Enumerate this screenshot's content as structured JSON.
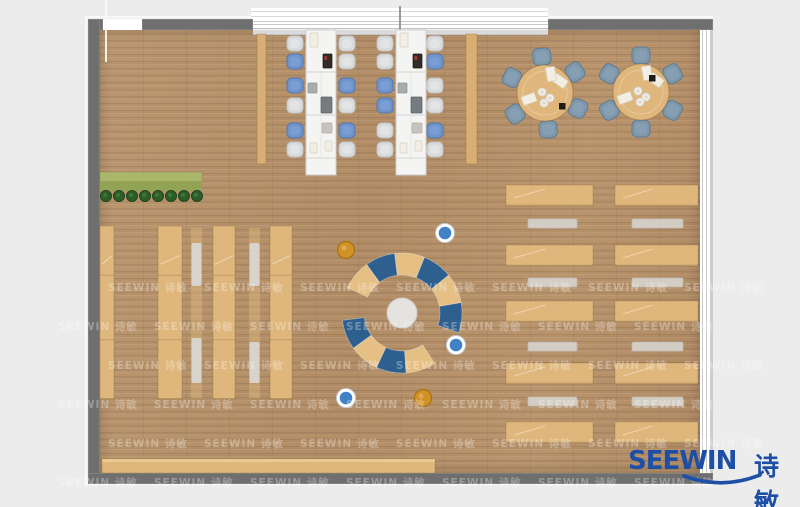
{
  "logo": {
    "text_en": "SEEWIN",
    "text_cn": "诗敏",
    "color": "#1d4fa7"
  },
  "watermark": {
    "text": "SEEWIN 诗敏",
    "color": "rgba(255,255,255,0.30)",
    "row0_y": 280,
    "row_step": 39,
    "rows": 6,
    "col_step": 96,
    "x_even": 108,
    "x_odd": 58,
    "count": 7
  },
  "palette": {
    "bg": "#ececec",
    "wall": "#6f6f6f",
    "floor": "#b6926b",
    "wood": "#dfb77c",
    "wood_dark": "#d7ae74",
    "wood_edge": "rgba(120,80,30,0.30)",
    "table_white": "#f4f4f3",
    "table_edge": "#cfcfcf",
    "seam": "#d9d9d9",
    "chair_gray": "#d9dadb",
    "chair_gray_edge": "#bfc1c3",
    "chair_blue": "#6f94cc",
    "chair_blue_edge": "#5577ad",
    "chair_steel": "#7d97ab",
    "chair_steel_edge": "#5f7b92",
    "bench_gray": "#d6d3cc",
    "bench_edge": "#c2bfb8",
    "mat": "#d9d6d0",
    "arc_tan": "#e5bf83",
    "arc_blue": "#2d608f",
    "center_circle": "#e5e3df",
    "center_edge": "#cfcdc8",
    "pouf_blue": "#4181c6",
    "pouf_orange": "#d09125",
    "pouf_orange_edge": "#a86f12",
    "plant_light": "#aab76a",
    "plant_dark": "#93a355",
    "tree": "#2f5d2a",
    "tree_edge": "#1f4420",
    "item_paper": "#f2eee3",
    "item_paper_edge": "#d6d0bf",
    "item_dark": "#332b26",
    "item_laptop": "#a7acaf",
    "item_laptop_dark": "#757b7f",
    "item_tray": "#c7c4bd"
  },
  "room": {
    "floor": {
      "x": 100,
      "y": 29,
      "w": 600,
      "h": 444
    },
    "outline": {
      "x": 85,
      "y": 16,
      "w": 624,
      "h": 465
    },
    "walls": [
      {
        "name": "wall-top-corner-left",
        "x": 88,
        "y": 19,
        "w": 15,
        "h": 11
      },
      {
        "name": "wall-top-left",
        "x": 142,
        "y": 19,
        "w": 111,
        "h": 11
      },
      {
        "name": "wall-top-right",
        "x": 548,
        "y": 19,
        "w": 165,
        "h": 11
      },
      {
        "name": "wall-left",
        "x": 88,
        "y": 19,
        "w": 12,
        "h": 465
      },
      {
        "name": "wall-bottom",
        "x": 88,
        "y": 473,
        "w": 625,
        "h": 11
      },
      {
        "name": "wall-right-segment",
        "x": 700,
        "y": 110,
        "w": 13,
        "h": 70
      }
    ],
    "windows": {
      "top": {
        "x": 253,
        "y": 19,
        "w": 295,
        "h": 11
      },
      "top_outer": {
        "x": 251,
        "y": 6,
        "w": 297,
        "h": 13
      },
      "top_sill": {
        "x": 253,
        "y": 30,
        "w": 295,
        "h": 4
      },
      "divider": {
        "x": 399,
        "y": 6,
        "w": 2,
        "h": 24
      },
      "right": {
        "x": 700,
        "y": 30,
        "w": 10,
        "h": 443
      },
      "door_gap": {
        "x": 103,
        "y": 19,
        "w": 39,
        "h": 11
      },
      "door_line": {
        "x": 105,
        "y": 0,
        "w": 2,
        "h": 62
      }
    }
  },
  "furniture": {
    "side_panels": [
      {
        "x": 257,
        "y": 34,
        "w": 9,
        "h": 130
      },
      {
        "x": 466,
        "y": 34,
        "w": 11,
        "h": 130
      }
    ],
    "planter": {
      "x": 100,
      "y": 172,
      "w": 102,
      "h": 19,
      "trees": 8,
      "tree_y": 196,
      "tree_x0": 106,
      "tree_dx": 13,
      "tree_r": 5.5
    },
    "shelves": [
      {
        "x": 100,
        "y": 226,
        "w": 14,
        "h": 174
      },
      {
        "x": 158,
        "y": 226,
        "w": 24,
        "h": 174
      },
      {
        "x": 213,
        "y": 226,
        "w": 22,
        "h": 174
      },
      {
        "x": 270,
        "y": 226,
        "w": 22,
        "h": 174
      }
    ],
    "mat_strips": [
      {
        "x": 191,
        "y": 228,
        "w": 11,
        "h": 170,
        "mats": [
          [
            243,
            43
          ],
          [
            338,
            45
          ]
        ]
      },
      {
        "x": 249,
        "y": 228,
        "w": 11,
        "h": 170,
        "mats": [
          [
            243,
            43
          ],
          [
            342,
            41
          ]
        ]
      }
    ],
    "bottom_bench": {
      "x": 102,
      "y": 459,
      "w": 333,
      "h": 14
    },
    "desk_columns": [
      {
        "x": 506,
        "w": 87
      },
      {
        "x": 615,
        "w": 83
      }
    ],
    "desk_rows_y": [
      185,
      245,
      301,
      363,
      422
    ],
    "desk_h": 21,
    "bench_columns": [
      {
        "x": 528,
        "w": 49
      },
      {
        "x": 632,
        "w": 51
      }
    ],
    "bench_rows_y": [
      219,
      278,
      342,
      397
    ],
    "bench_h": 9,
    "long_tables": [
      {
        "x": 306,
        "y": 30,
        "w": 30,
        "h": 145,
        "chairs_left_x": 295,
        "chairs_right_x": 347,
        "chair_rows_y": [
          44,
          62,
          86,
          106,
          131,
          150
        ],
        "left_colors": [
          "g",
          "b",
          "b",
          "g",
          "b",
          "g"
        ],
        "right_colors": [
          "g",
          "g",
          "b",
          "g",
          "b",
          "g"
        ]
      },
      {
        "x": 396,
        "y": 30,
        "w": 30,
        "h": 145,
        "chairs_left_x": 385,
        "chairs_right_x": 435,
        "chair_rows_y": [
          44,
          62,
          86,
          106,
          131,
          150
        ],
        "left_colors": [
          "g",
          "g",
          "b",
          "b",
          "g",
          "g"
        ],
        "right_colors": [
          "g",
          "b",
          "g",
          "g",
          "b",
          "g"
        ]
      }
    ],
    "table_seams_dy": [
      42,
      85,
      128
    ],
    "table_items": [
      [
        4,
        3,
        8,
        14,
        "paper"
      ],
      [
        17,
        24,
        9,
        14,
        "dark"
      ],
      [
        2,
        53,
        9,
        10,
        "laptop"
      ],
      [
        15,
        67,
        11,
        16,
        "laptop_dark"
      ],
      [
        16,
        93,
        10,
        10,
        "tray"
      ],
      [
        4,
        113,
        7,
        10,
        "paper"
      ],
      [
        19,
        111,
        7,
        10,
        "paper"
      ]
    ],
    "round_tables": [
      {
        "cx": 545,
        "cy": 93,
        "r": 28,
        "chair_r": 36,
        "chair_angles": [
          95,
          155,
          215,
          275,
          335,
          35
        ],
        "dark_item": [
          14,
          10
        ]
      },
      {
        "cx": 641,
        "cy": 92,
        "r": 28,
        "chair_r": 36,
        "chair_angles": [
          90,
          150,
          210,
          270,
          330,
          30
        ],
        "dark_item": [
          8,
          -17
        ]
      }
    ],
    "round_decor": {
      "plates": [
        [
          -3,
          -1
        ],
        [
          5,
          5
        ],
        [
          -1,
          10
        ]
      ],
      "papers": [
        [
          15,
          -12,
          35
        ],
        [
          -16,
          6,
          -20
        ],
        [
          6,
          -19,
          80
        ]
      ]
    },
    "lounge": {
      "cx": 402,
      "cy": 313,
      "r_inner": 38,
      "r_outer": 60,
      "center_r": 15,
      "upper_arc": {
        "start": 155,
        "step": -29,
        "colors": [
          "tan",
          "blue",
          "tan",
          "blue",
          "tan",
          "blue"
        ]
      },
      "lower_arc": {
        "start": 187,
        "step": 29,
        "colors": [
          "blue",
          "tan",
          "blue",
          "tan"
        ]
      }
    },
    "poufs": [
      {
        "x": 346,
        "y": 250,
        "c": "orange"
      },
      {
        "x": 445,
        "y": 233,
        "c": "blue"
      },
      {
        "x": 456,
        "y": 345,
        "c": "blue"
      },
      {
        "x": 346,
        "y": 398,
        "c": "blue"
      },
      {
        "x": 423,
        "y": 398,
        "c": "orange"
      }
    ]
  }
}
